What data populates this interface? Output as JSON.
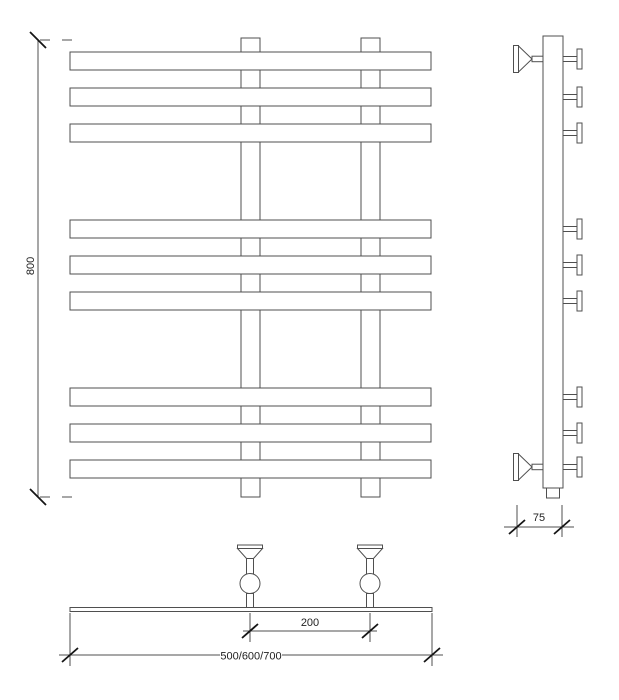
{
  "colors": {
    "background": "#ffffff",
    "line": "#4f4f4f",
    "tick": "#151515",
    "text": "#222222"
  },
  "views": {
    "front": {
      "bar_count": 9,
      "tube_count": 2
    },
    "side": {
      "bar_stub_count": 9,
      "valve_count": 2
    },
    "bottom": {
      "valve_count": 2
    }
  },
  "dimension_labels": {
    "height": "800",
    "depth": "75",
    "valve_spacing": "200",
    "width_options": "500/600/700"
  }
}
